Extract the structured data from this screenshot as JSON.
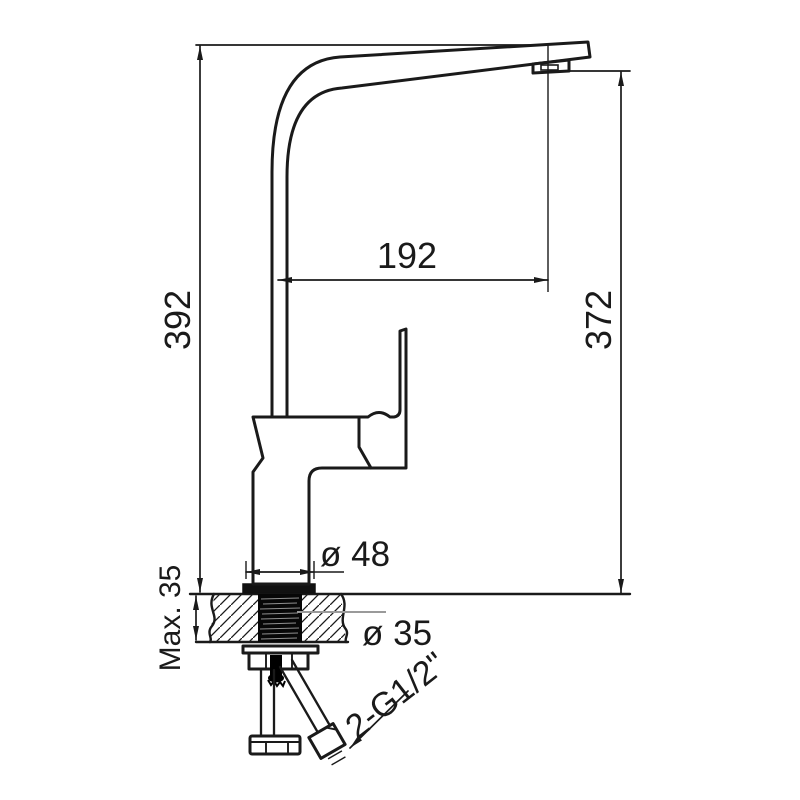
{
  "drawing": {
    "title": "single-lever kitchen mixer tap - dimensioned side elevation",
    "units": "mm",
    "background_color": "#ffffff",
    "line_color": "#1a1a1a",
    "leader_gray_color": "#9a9a9a",
    "labels": {
      "overall_height": "392",
      "spout_outlet_height": "372",
      "spout_reach": "192",
      "base_diameter": "ø 48",
      "mounting_hole_diameter": "ø 35",
      "max_deck_thickness": "Max. 35",
      "hose_thread": "2-G1/2\""
    }
  }
}
